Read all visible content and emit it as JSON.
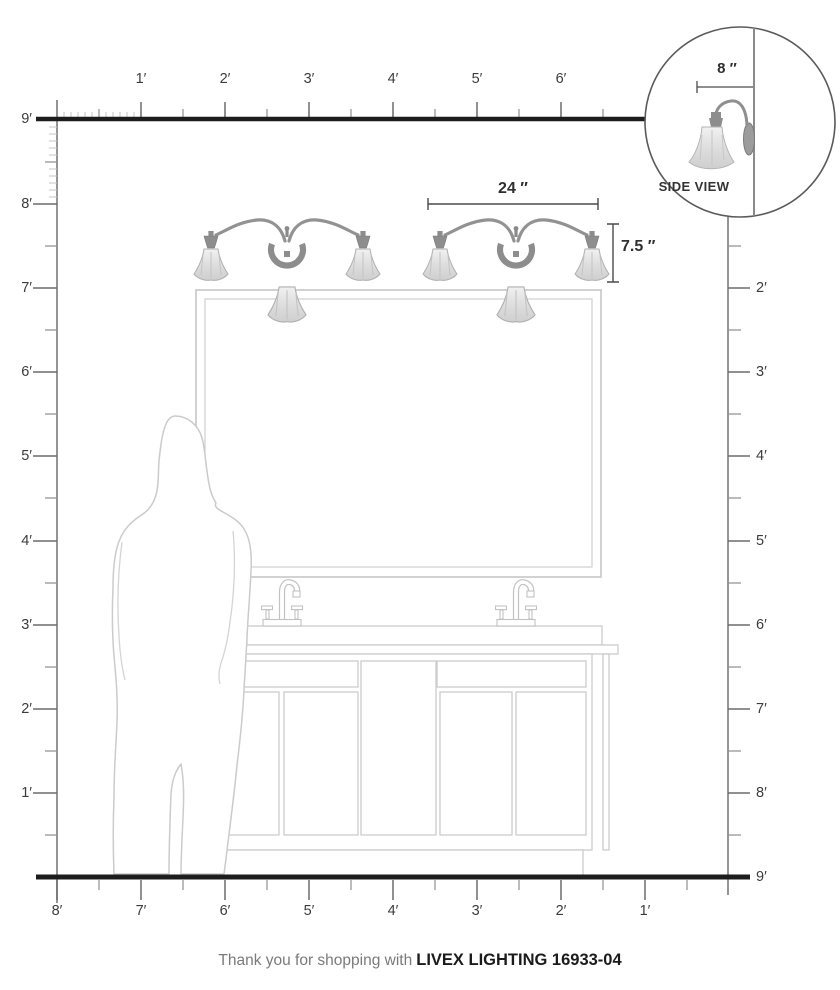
{
  "rulers": {
    "top": {
      "labels": [
        "1′",
        "2′",
        "3′",
        "4′",
        "5′",
        "6′"
      ]
    },
    "left": {
      "labels": [
        "9′",
        "8′",
        "7′",
        "6′",
        "5′",
        "4′",
        "3′",
        "2′",
        "1′"
      ]
    },
    "right": {
      "labels": [
        "2′",
        "3′",
        "4′",
        "5′",
        "6′",
        "7′",
        "8′",
        "9′"
      ]
    },
    "bottom": {
      "labels": [
        "8′",
        "7′",
        "6′",
        "5′",
        "4′",
        "3′",
        "2′",
        "1′"
      ]
    }
  },
  "dimensions": {
    "fixture_width": "24 ″",
    "fixture_height": "7.5 ″",
    "wall_depth": "8 ″"
  },
  "side_view": {
    "label": "SIDE VIEW"
  },
  "footer": {
    "prefix": "Thank you for shopping with",
    "product": "LIVEX LIGHTING 16933-04"
  },
  "colors": {
    "frame_line": "#1d1d1d",
    "tick_major": "#6b6b6b",
    "tick_minor": "#c6c6c6",
    "drawing_outline": "#cbcbcb",
    "fixture_metal": "#8d8d8d",
    "fixture_glass": "#dedede",
    "dimension_line": "#4a4a4a",
    "label_text": "#3c3c3c",
    "footer_muted": "#7a7a7a",
    "footer_product": "#1b1b1b"
  }
}
